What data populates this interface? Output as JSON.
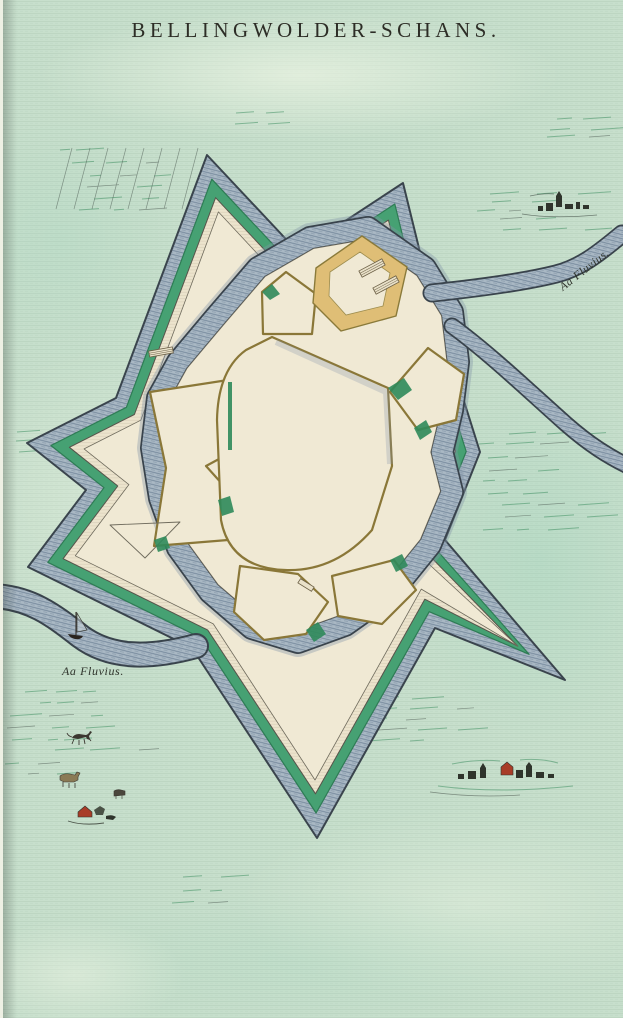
{
  "page": {
    "title": "BELLINGWOLDER-SCHANS.",
    "type_note": "engraved town plan of a star fort, hand coloured"
  },
  "labels": {
    "river_label_right": "Aa Fluvius.",
    "river_label_left": "Aa Fluvius."
  },
  "colors": {
    "parchment": "#c7dfcc",
    "parchment_light": "#e2efdd",
    "water": "#a9b8c4",
    "water_line": "#72869a",
    "water_edge": "#3a444d",
    "glacis_green": "#46a173",
    "green_edge": "#2e7c54",
    "cream": "#ece4cd",
    "cream_interior": "#f0e9d4",
    "wall_tan": "#8a7738",
    "ravelin_yellow": "#dfbe76",
    "ink": "#2d2d26",
    "field_green": "#3f8f63",
    "sketch_red": "#a83c28"
  }
}
